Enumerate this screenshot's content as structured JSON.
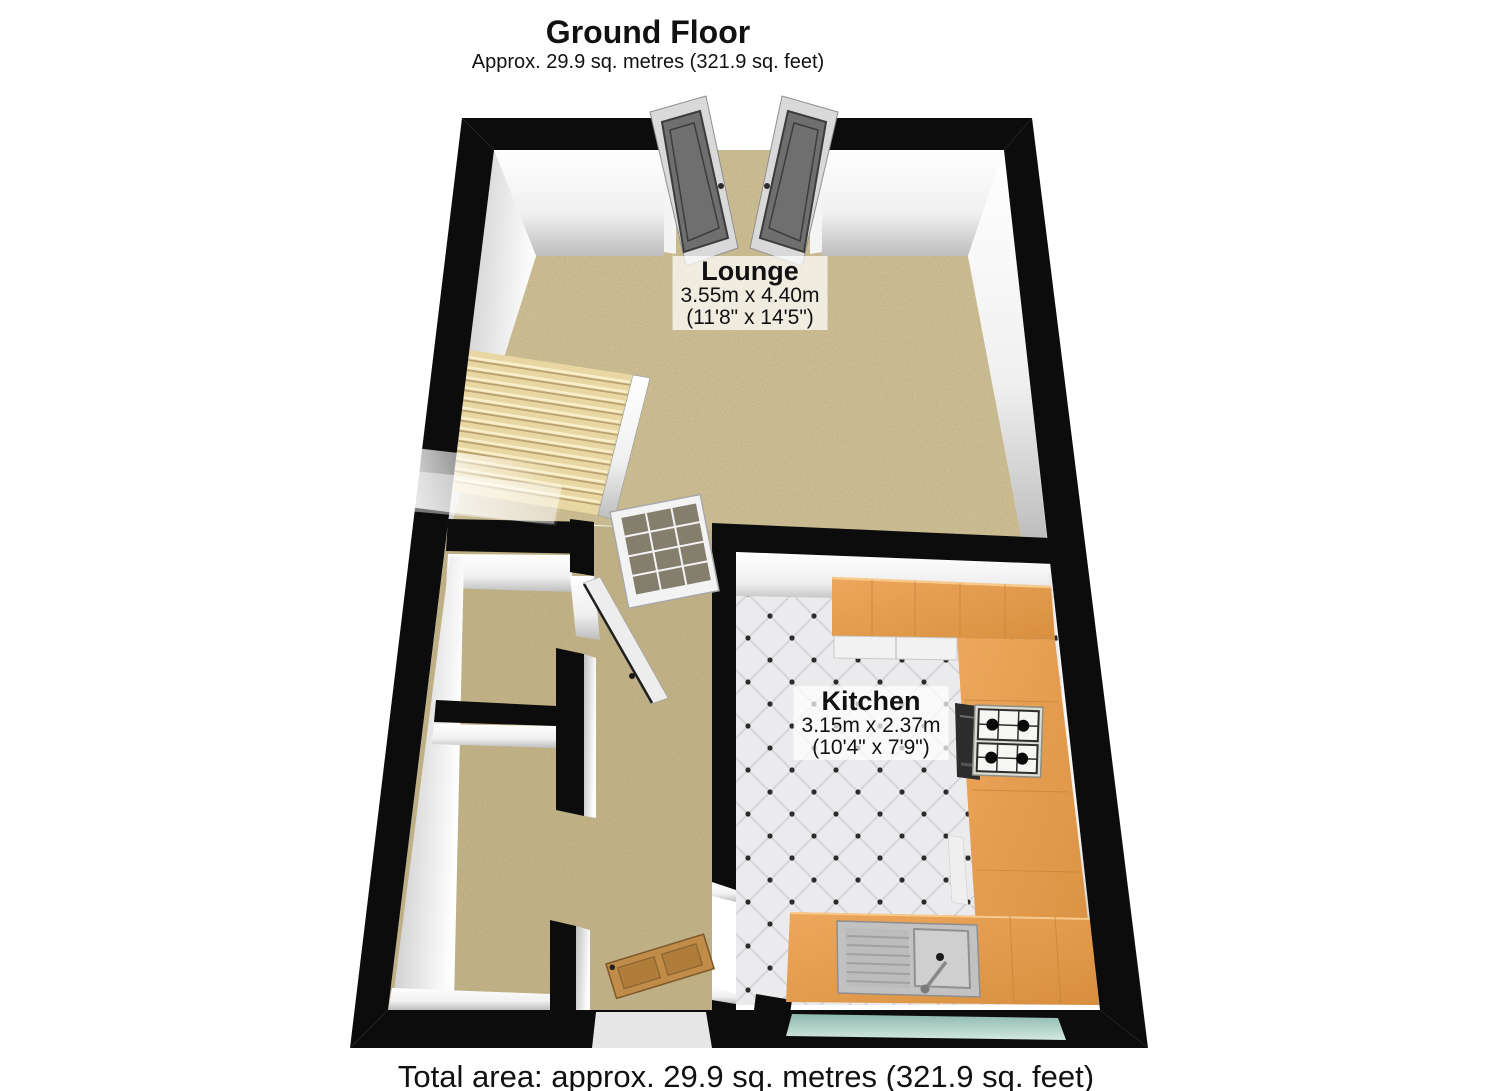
{
  "header": {
    "title": "Ground Floor",
    "subtitle": "Approx.  29.9 sq. metres (321.9 sq. feet)"
  },
  "rooms": {
    "lounge": {
      "name": "Lounge",
      "size_metric": "3.55m x 4.40m",
      "size_imperial": "(11'8\" x 14'5\")"
    },
    "kitchen": {
      "name": "Kitchen",
      "size_metric": "3.15m x 2.37m",
      "size_imperial": "(10'4\" x 7'9\")"
    }
  },
  "footer": {
    "total_area": "Total area: approx.  29.9 sq. metres (321.9 sq. feet)"
  },
  "objects": {
    "staircase": "staircase",
    "french_doors": "double-french-doors",
    "glazed_door": "glazed-internal-door",
    "front_door": "wooden-front-door",
    "hob": "gas-hob-4-burner",
    "oven": "built-in-oven",
    "sink": "sink-with-drainer-and-tap",
    "worktop": "l-shaped-kitchen-worktop",
    "window": "rear-window"
  },
  "colors": {
    "wall": "#0c0c0c",
    "lounge_carpet": "#d5c69b",
    "hall_carpet": "#c9b98d",
    "kitchen_tile": "#ebebee",
    "worktop_wood": "#e09a50",
    "window_teal": "#a8cec4",
    "door_grey": "#6f6f6f",
    "front_door_wood": "#c18c48",
    "stairs": "#e9d7a3"
  },
  "stairs_geometry": {
    "corners": [
      [
        470,
        350
      ],
      [
        633,
        375
      ],
      [
        598,
        515
      ],
      [
        432,
        488
      ]
    ],
    "steps": 14
  }
}
